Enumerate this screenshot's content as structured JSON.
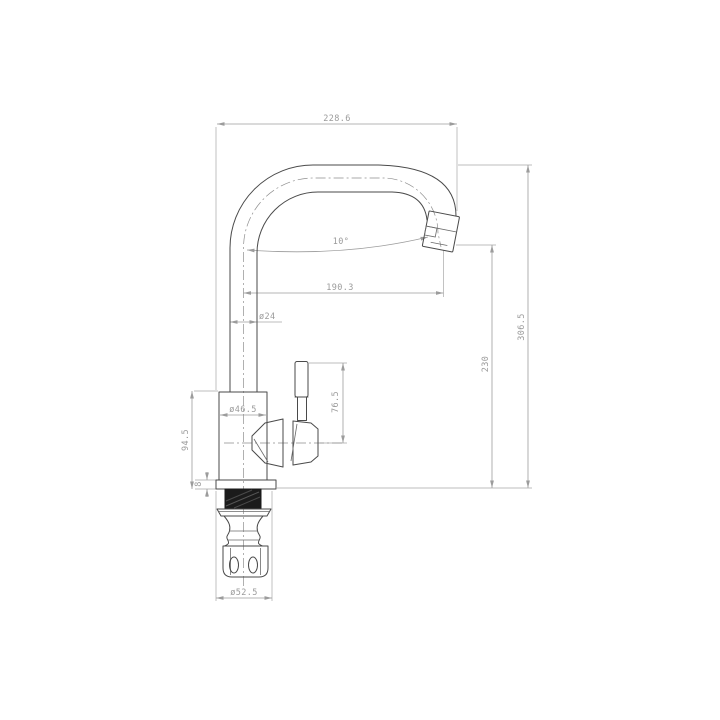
{
  "drawing": {
    "colors": {
      "outline": "#4a4a4a",
      "dimension": "#9c9c9c",
      "background": "#ffffff"
    },
    "dimensions": {
      "top_width": "228.6",
      "overall_height": "306.5",
      "outlet_height": "230",
      "spout_reach": "190.3",
      "spout_angle": "10°",
      "spout_tube_diameter": "ø24",
      "body_diameter": "ø46.5",
      "body_height": "94.5",
      "base_plate_thickness": "8",
      "lever_height": "76.5",
      "flange_diameter": "ø52.5"
    }
  }
}
